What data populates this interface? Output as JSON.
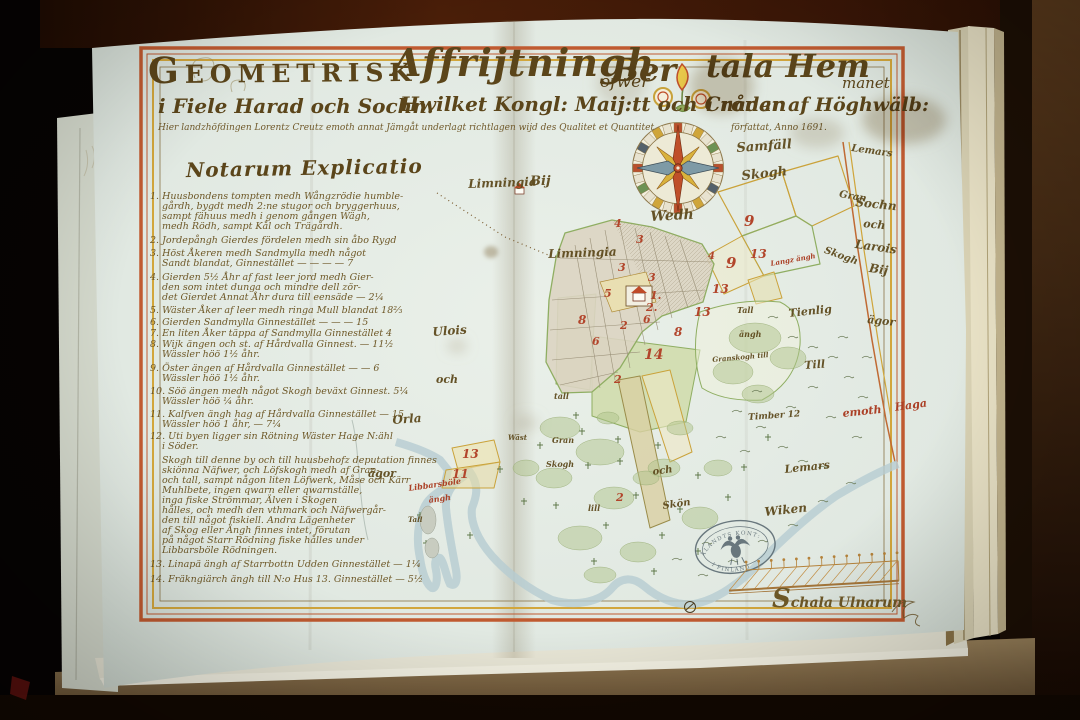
{
  "title": {
    "w1": "Geometrisk",
    "w2": "Affrijtningh",
    "w3": "öfwer",
    "w4": "Ber",
    "w5": "tala Hem",
    "w6": "manet",
    "l2a": "i Fiele Harad och Sochn.",
    "l2b": "Hwilket Kongl: Maij:tt och Cronan",
    "l2c": "i nåder af Höghwälb:",
    "l3": "Hier landzhöfdingen Lorentz Creutz emoth annat Jämgåt underlagt richtlagen wijd des Qualitet et Quantitet"
  },
  "explicatio_heading": "Notarum Explicatio",
  "scale": {
    "label": "Schala Ulnarum"
  },
  "stamp": {
    "top": "ÅLANDTS KONT:",
    "bottom": "I FINLAND"
  },
  "colors": {
    "ink": "#5e4716",
    "red_numbers": "#b2452b",
    "border_orange": "#c05a30",
    "border_yellow": "#d2a63c",
    "field_green": "#8fae62",
    "paper": "#e3eae2"
  },
  "texts": [
    {
      "t": "1. Huusbondens tompten medh Wångzrödie humble-",
      "x": 150,
      "y": 192,
      "fs": 9.5,
      "c": "manu",
      "n": "explicatio-item-1"
    },
    {
      "t": "gårdh, bygdt medh 2:ne stugor och bryggerhuus,",
      "x": 162,
      "y": 202,
      "fs": 9.5,
      "c": "manu",
      "n": "explicatio-item-1"
    },
    {
      "t": "sampt fähuus medh i genom gången Wägh,",
      "x": 162,
      "y": 212,
      "fs": 9.5,
      "c": "manu",
      "n": "explicatio-item-1"
    },
    {
      "t": "medh Rödh, sampt Kål och Trägårdh.",
      "x": 162,
      "y": 222,
      "fs": 9.5,
      "c": "manu",
      "n": "explicatio-item-1"
    },
    {
      "t": "2. Jordepångh Gierdes fördelen medh sin åbo Rygd",
      "x": 150,
      "y": 236,
      "fs": 9.5,
      "c": "manu",
      "n": "explicatio-item-2"
    },
    {
      "t": "3. Höst Åkeren medh Sandmylla medh något",
      "x": 150,
      "y": 249,
      "fs": 9.5,
      "c": "manu",
      "n": "explicatio-item-3"
    },
    {
      "t": "Sandt blandat, Ginnestället — — — — 7",
      "x": 162,
      "y": 259,
      "fs": 9.5,
      "c": "manu",
      "n": "explicatio-item-3"
    },
    {
      "t": "4. Gierden 5½ Åhr af fast leer jord medh Gier-",
      "x": 150,
      "y": 273,
      "fs": 9.5,
      "c": "manu",
      "n": "explicatio-item-4"
    },
    {
      "t": "den som intet dunga och mindre dell zör-",
      "x": 162,
      "y": 283,
      "fs": 9.5,
      "c": "manu",
      "n": "explicatio-item-4"
    },
    {
      "t": "det Gierdet Annat Åhr dura till eensäde — 2¼",
      "x": 162,
      "y": 293,
      "fs": 9.5,
      "c": "manu",
      "n": "explicatio-item-4"
    },
    {
      "t": "5. Wäster Åker af leer medh ringa Mull blandat 18⅔",
      "x": 150,
      "y": 306,
      "fs": 9.5,
      "c": "manu",
      "n": "explicatio-item-5"
    },
    {
      "t": "6. Gierden Sandmylla Ginnestället — — — 15",
      "x": 150,
      "y": 318,
      "fs": 9.5,
      "c": "manu",
      "n": "explicatio-item-6"
    },
    {
      "t": "7. En liten Åker täppa af Sandmylla Ginnestället 4",
      "x": 150,
      "y": 329,
      "fs": 9.5,
      "c": "manu",
      "n": "explicatio-item-7"
    },
    {
      "t": "8. Wijk ängen och st. af Hårdvalla Ginnest. — 11½",
      "x": 150,
      "y": 340,
      "fs": 9.5,
      "c": "manu",
      "n": "explicatio-item-8"
    },
    {
      "t": "Wässler höö 1½ åhr.",
      "x": 162,
      "y": 350,
      "fs": 9.5,
      "c": "manu",
      "n": "explicatio-item-8"
    },
    {
      "t": "9. Öster ängen af Hårdvalla Ginnestället — — 6",
      "x": 150,
      "y": 364,
      "fs": 9.5,
      "c": "manu",
      "n": "explicatio-item-9"
    },
    {
      "t": "Wässler höö 1½ åhr.",
      "x": 162,
      "y": 374,
      "fs": 9.5,
      "c": "manu",
      "n": "explicatio-item-9"
    },
    {
      "t": "10. Söö ängen medh något Skogh beväxt Ginnest. 5¼",
      "x": 150,
      "y": 387,
      "fs": 9.5,
      "c": "manu",
      "n": "explicatio-item-10"
    },
    {
      "t": "Wässler höö ¼ åhr.",
      "x": 162,
      "y": 397,
      "fs": 9.5,
      "c": "manu",
      "n": "explicatio-item-10"
    },
    {
      "t": "11. Kalfven ängh hag af Hårdvalla Ginnestället — 15",
      "x": 150,
      "y": 410,
      "fs": 9.5,
      "c": "manu",
      "n": "explicatio-item-11"
    },
    {
      "t": "Wässler höö 1 åhr, — 7¼",
      "x": 162,
      "y": 420,
      "fs": 9.5,
      "c": "manu",
      "n": "explicatio-item-11"
    },
    {
      "t": "12. Uti byen ligger sin Rötning Wäster Hage N:ähl",
      "x": 150,
      "y": 432,
      "fs": 9.5,
      "c": "manu",
      "n": "explicatio-item-12"
    },
    {
      "t": "i Söder.",
      "x": 162,
      "y": 442,
      "fs": 9.5,
      "c": "manu",
      "n": "explicatio-item-12"
    },
    {
      "t": "Skogh till denne by och till huusbehofz deputation finnes",
      "x": 162,
      "y": 456,
      "fs": 9.5,
      "c": "manu",
      "n": "explicatio-paragraph"
    },
    {
      "t": "skiönna Näfwer, och Löfskogh medh af Gran-",
      "x": 162,
      "y": 466,
      "fs": 9.5,
      "c": "manu",
      "n": "explicatio-paragraph"
    },
    {
      "t": "och tall, sampt någon liten Löfwerk, Måse och Kärr",
      "x": 162,
      "y": 476,
      "fs": 9.5,
      "c": "manu",
      "n": "explicatio-paragraph"
    },
    {
      "t": "Muhlbete, ingen qwarn eller qwarnställe,",
      "x": 162,
      "y": 486,
      "fs": 9.5,
      "c": "manu",
      "n": "explicatio-paragraph"
    },
    {
      "t": "inga fiske Strömmar, Älven i Skogen",
      "x": 162,
      "y": 496,
      "fs": 9.5,
      "c": "manu",
      "n": "explicatio-paragraph"
    },
    {
      "t": "hålles, och medh den vthmark och Näfwergår-",
      "x": 162,
      "y": 506,
      "fs": 9.5,
      "c": "manu",
      "n": "explicatio-paragraph"
    },
    {
      "t": "den till något fiskiell. Andra Lägenheter",
      "x": 162,
      "y": 516,
      "fs": 9.5,
      "c": "manu",
      "n": "explicatio-paragraph"
    },
    {
      "t": "af Skog eller Ängh finnes intet, förutan",
      "x": 162,
      "y": 526,
      "fs": 9.5,
      "c": "manu",
      "n": "explicatio-paragraph"
    },
    {
      "t": "på något Starr Rödning fiske hålles under",
      "x": 162,
      "y": 536,
      "fs": 9.5,
      "c": "manu",
      "n": "explicatio-paragraph"
    },
    {
      "t": "Libbarsböle Rödningen.",
      "x": 162,
      "y": 546,
      "fs": 9.5,
      "c": "manu",
      "n": "explicatio-paragraph"
    },
    {
      "t": "13. Linapä ängh af Starrbottn Udden Ginnestället — 1¼",
      "x": 150,
      "y": 560,
      "fs": 9.5,
      "c": "manu",
      "n": "explicatio-item-13"
    },
    {
      "t": "14. Fräkngiärch ängh till N:o Hus 13. Ginnestället — 5½",
      "x": 150,
      "y": 575,
      "fs": 9.5,
      "c": "manu",
      "n": "explicatio-item-14"
    },
    {
      "t": "författat, Anno 1691.",
      "x": 731,
      "y": 124,
      "fs": 9,
      "c": "manu",
      "n": "date-note"
    },
    {
      "t": "Samfäll",
      "x": 736,
      "y": 142,
      "fs": 13,
      "c": "place",
      "r": -4,
      "n": "label-samfall"
    },
    {
      "t": "Skogh",
      "x": 741,
      "y": 170,
      "fs": 13,
      "c": "place",
      "r": -6,
      "n": "label-skogh"
    },
    {
      "t": "Wedh",
      "x": 650,
      "y": 210,
      "fs": 14,
      "c": "place",
      "r": -3,
      "n": "label-wedh"
    },
    {
      "t": "Limningia",
      "x": 468,
      "y": 178,
      "fs": 12,
      "c": "place",
      "r": -2,
      "n": "label-limningia-bij"
    },
    {
      "t": "Bij",
      "x": 530,
      "y": 175,
      "fs": 13,
      "c": "place",
      "n": "label-limningia-bij"
    },
    {
      "t": "Limningia",
      "x": 548,
      "y": 248,
      "fs": 12,
      "c": "place",
      "r": -2,
      "n": "label-limningia"
    },
    {
      "t": "Gran",
      "x": 840,
      "y": 190,
      "fs": 10,
      "c": "place",
      "r": 10,
      "n": "label-gran"
    },
    {
      "t": "Skogh",
      "x": 826,
      "y": 246,
      "fs": 10,
      "c": "place",
      "r": 20,
      "n": "label-granskogh"
    },
    {
      "t": "Lemars",
      "x": 852,
      "y": 144,
      "fs": 10,
      "c": "place",
      "r": 8,
      "n": "label-lemars-sochn"
    },
    {
      "t": "Sochn",
      "x": 856,
      "y": 196,
      "fs": 12,
      "c": "place",
      "r": 6,
      "n": "label-lemars-sochn"
    },
    {
      "t": "och",
      "x": 864,
      "y": 218,
      "fs": 11,
      "c": "place",
      "r": 6,
      "n": "label-lemars-sochn"
    },
    {
      "t": "Larois",
      "x": 856,
      "y": 238,
      "fs": 12,
      "c": "place",
      "r": 8,
      "n": "label-larois"
    },
    {
      "t": "Bij",
      "x": 870,
      "y": 262,
      "fs": 12,
      "c": "place",
      "r": 8,
      "n": "label-larois"
    },
    {
      "t": "ägor",
      "x": 868,
      "y": 314,
      "fs": 11,
      "c": "place",
      "r": 6,
      "n": "label-agor-right"
    },
    {
      "t": "Tienlig",
      "x": 788,
      "y": 308,
      "fs": 11,
      "c": "place",
      "r": -6,
      "n": "label-tienlig"
    },
    {
      "t": "Till",
      "x": 804,
      "y": 360,
      "fs": 11,
      "c": "place",
      "r": -4,
      "n": "label-till"
    },
    {
      "t": "Tall",
      "x": 737,
      "y": 306,
      "fs": 8,
      "c": "place",
      "n": "label-tall"
    },
    {
      "t": "ängh",
      "x": 739,
      "y": 330,
      "fs": 8,
      "c": "place",
      "n": "label-angh"
    },
    {
      "t": "Granskogh till",
      "x": 712,
      "y": 356,
      "fs": 7,
      "c": "place",
      "r": -5,
      "n": "label-granskogh-till"
    },
    {
      "t": "Timber 12",
      "x": 748,
      "y": 414,
      "fs": 9,
      "c": "place",
      "r": -4,
      "n": "label-timber"
    },
    {
      "t": "emoth",
      "x": 842,
      "y": 408,
      "fs": 11,
      "c": "redl",
      "r": -6,
      "n": "label-emoth-haga"
    },
    {
      "t": "Haga",
      "x": 894,
      "y": 402,
      "fs": 11,
      "c": "redl",
      "r": -8,
      "n": "label-emoth-haga"
    },
    {
      "t": "Lemars",
      "x": 784,
      "y": 464,
      "fs": 11,
      "c": "place",
      "r": -6,
      "n": "label-lemars-wiken"
    },
    {
      "t": "Wiken",
      "x": 764,
      "y": 506,
      "fs": 12,
      "c": "place",
      "r": -6,
      "n": "label-lemars-wiken"
    },
    {
      "t": "Ulois",
      "x": 432,
      "y": 326,
      "fs": 12,
      "c": "place",
      "r": -4,
      "n": "label-ulois"
    },
    {
      "t": "och",
      "x": 436,
      "y": 374,
      "fs": 11,
      "c": "place",
      "n": "label-och"
    },
    {
      "t": "Orla",
      "x": 392,
      "y": 414,
      "fs": 12,
      "c": "place",
      "r": -4,
      "n": "label-orla"
    },
    {
      "t": "ägor",
      "x": 368,
      "y": 468,
      "fs": 11,
      "c": "place",
      "n": "label-agor-left"
    },
    {
      "t": "Langz ängh",
      "x": 770,
      "y": 260,
      "fs": 7,
      "c": "redl",
      "r": -10,
      "n": "label-langz-angh"
    },
    {
      "t": "Libbarsböle",
      "x": 408,
      "y": 484,
      "fs": 8,
      "c": "redl",
      "r": -8,
      "n": "label-bole-angh"
    },
    {
      "t": "ängh",
      "x": 428,
      "y": 496,
      "fs": 8,
      "c": "redl",
      "r": -8,
      "n": "label-bole-angh"
    },
    {
      "t": "tall",
      "x": 554,
      "y": 392,
      "fs": 8,
      "c": "place",
      "n": "label-tall-2"
    },
    {
      "t": "Gran",
      "x": 552,
      "y": 436,
      "fs": 8,
      "c": "place",
      "n": "label-gran-2"
    },
    {
      "t": "Skogh",
      "x": 546,
      "y": 460,
      "fs": 8,
      "c": "place",
      "n": "label-skogh-2"
    },
    {
      "t": "lill",
      "x": 588,
      "y": 504,
      "fs": 8,
      "c": "place",
      "n": "label-lill"
    },
    {
      "t": "och",
      "x": 652,
      "y": 468,
      "fs": 10,
      "c": "place",
      "r": -8,
      "n": "label-och-2"
    },
    {
      "t": "Skön",
      "x": 662,
      "y": 502,
      "fs": 10,
      "c": "place",
      "r": -8,
      "n": "label-skon"
    },
    {
      "t": "Wäst",
      "x": 508,
      "y": 434,
      "fs": 7,
      "c": "place",
      "n": "label-wast"
    },
    {
      "t": "Tall",
      "x": 408,
      "y": 516,
      "fs": 7,
      "c": "place",
      "n": "label-tall-pen"
    },
    {
      "t": "4",
      "x": 614,
      "y": 218,
      "fs": 11,
      "c": "pnum",
      "n": "plot-number"
    },
    {
      "t": "3",
      "x": 636,
      "y": 234,
      "fs": 11,
      "c": "pnum",
      "n": "plot-number"
    },
    {
      "t": "3",
      "x": 618,
      "y": 262,
      "fs": 11,
      "c": "pnum",
      "n": "plot-number"
    },
    {
      "t": "3",
      "x": 648,
      "y": 272,
      "fs": 11,
      "c": "pnum",
      "n": "plot-number"
    },
    {
      "t": "5",
      "x": 604,
      "y": 288,
      "fs": 11,
      "c": "pnum",
      "n": "plot-number"
    },
    {
      "t": "1.",
      "x": 650,
      "y": 290,
      "fs": 11,
      "c": "pnum",
      "n": "plot-number"
    },
    {
      "t": "2.",
      "x": 646,
      "y": 302,
      "fs": 11,
      "c": "pnum",
      "n": "plot-number"
    },
    {
      "t": "6",
      "x": 643,
      "y": 314,
      "fs": 11,
      "c": "pnum",
      "n": "plot-number"
    },
    {
      "t": "8",
      "x": 578,
      "y": 314,
      "fs": 12,
      "c": "pnum",
      "n": "plot-number"
    },
    {
      "t": "2",
      "x": 620,
      "y": 320,
      "fs": 11,
      "c": "pnum",
      "n": "plot-number"
    },
    {
      "t": "6",
      "x": 592,
      "y": 336,
      "fs": 11,
      "c": "pnum",
      "n": "plot-number"
    },
    {
      "t": "14",
      "x": 644,
      "y": 348,
      "fs": 14,
      "c": "pnum",
      "n": "plot-number"
    },
    {
      "t": "8",
      "x": 674,
      "y": 326,
      "fs": 12,
      "c": "pnum",
      "n": "plot-number"
    },
    {
      "t": "13",
      "x": 694,
      "y": 306,
      "fs": 12,
      "c": "pnum",
      "n": "plot-number"
    },
    {
      "t": "13",
      "x": 712,
      "y": 283,
      "fs": 12,
      "c": "pnum",
      "n": "plot-number"
    },
    {
      "t": "13",
      "x": 750,
      "y": 248,
      "fs": 12,
      "c": "pnum",
      "n": "plot-number"
    },
    {
      "t": "9",
      "x": 744,
      "y": 214,
      "fs": 15,
      "c": "pnum",
      "n": "plot-number"
    },
    {
      "t": "9",
      "x": 726,
      "y": 256,
      "fs": 15,
      "c": "pnum",
      "n": "plot-number"
    },
    {
      "t": "4",
      "x": 708,
      "y": 252,
      "fs": 10,
      "c": "pnum",
      "n": "plot-number"
    },
    {
      "t": "2",
      "x": 614,
      "y": 374,
      "fs": 11,
      "c": "pnum",
      "n": "plot-number"
    },
    {
      "t": "2",
      "x": 616,
      "y": 492,
      "fs": 11,
      "c": "pnum",
      "n": "plot-number"
    },
    {
      "t": "13",
      "x": 462,
      "y": 448,
      "fs": 12,
      "c": "pnum",
      "n": "plot-number"
    },
    {
      "t": "11",
      "x": 452,
      "y": 468,
      "fs": 12,
      "c": "pnum",
      "n": "plot-number"
    }
  ]
}
